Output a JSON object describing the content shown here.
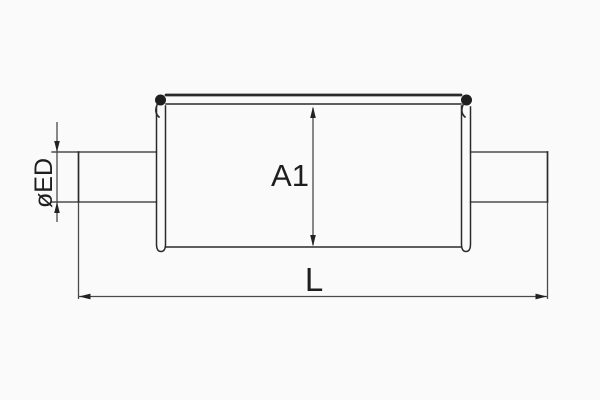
{
  "drawing": {
    "kind": "technical-drawing",
    "view": "side-section-with-dimensions",
    "dimensions": [
      {
        "id": "ED",
        "label": "øED",
        "orientation": "vertical",
        "target": "end-pipe-diameter"
      },
      {
        "id": "A1",
        "label": "A1",
        "orientation": "vertical",
        "target": "body-height"
      },
      {
        "id": "L",
        "label": "L",
        "orientation": "horizontal",
        "target": "overall-length"
      }
    ],
    "colors": {
      "background": "#fafafa",
      "object_line": "#2a2a2a",
      "dimension_line": "#4a4a4a",
      "text": "#1e1e1e"
    }
  }
}
